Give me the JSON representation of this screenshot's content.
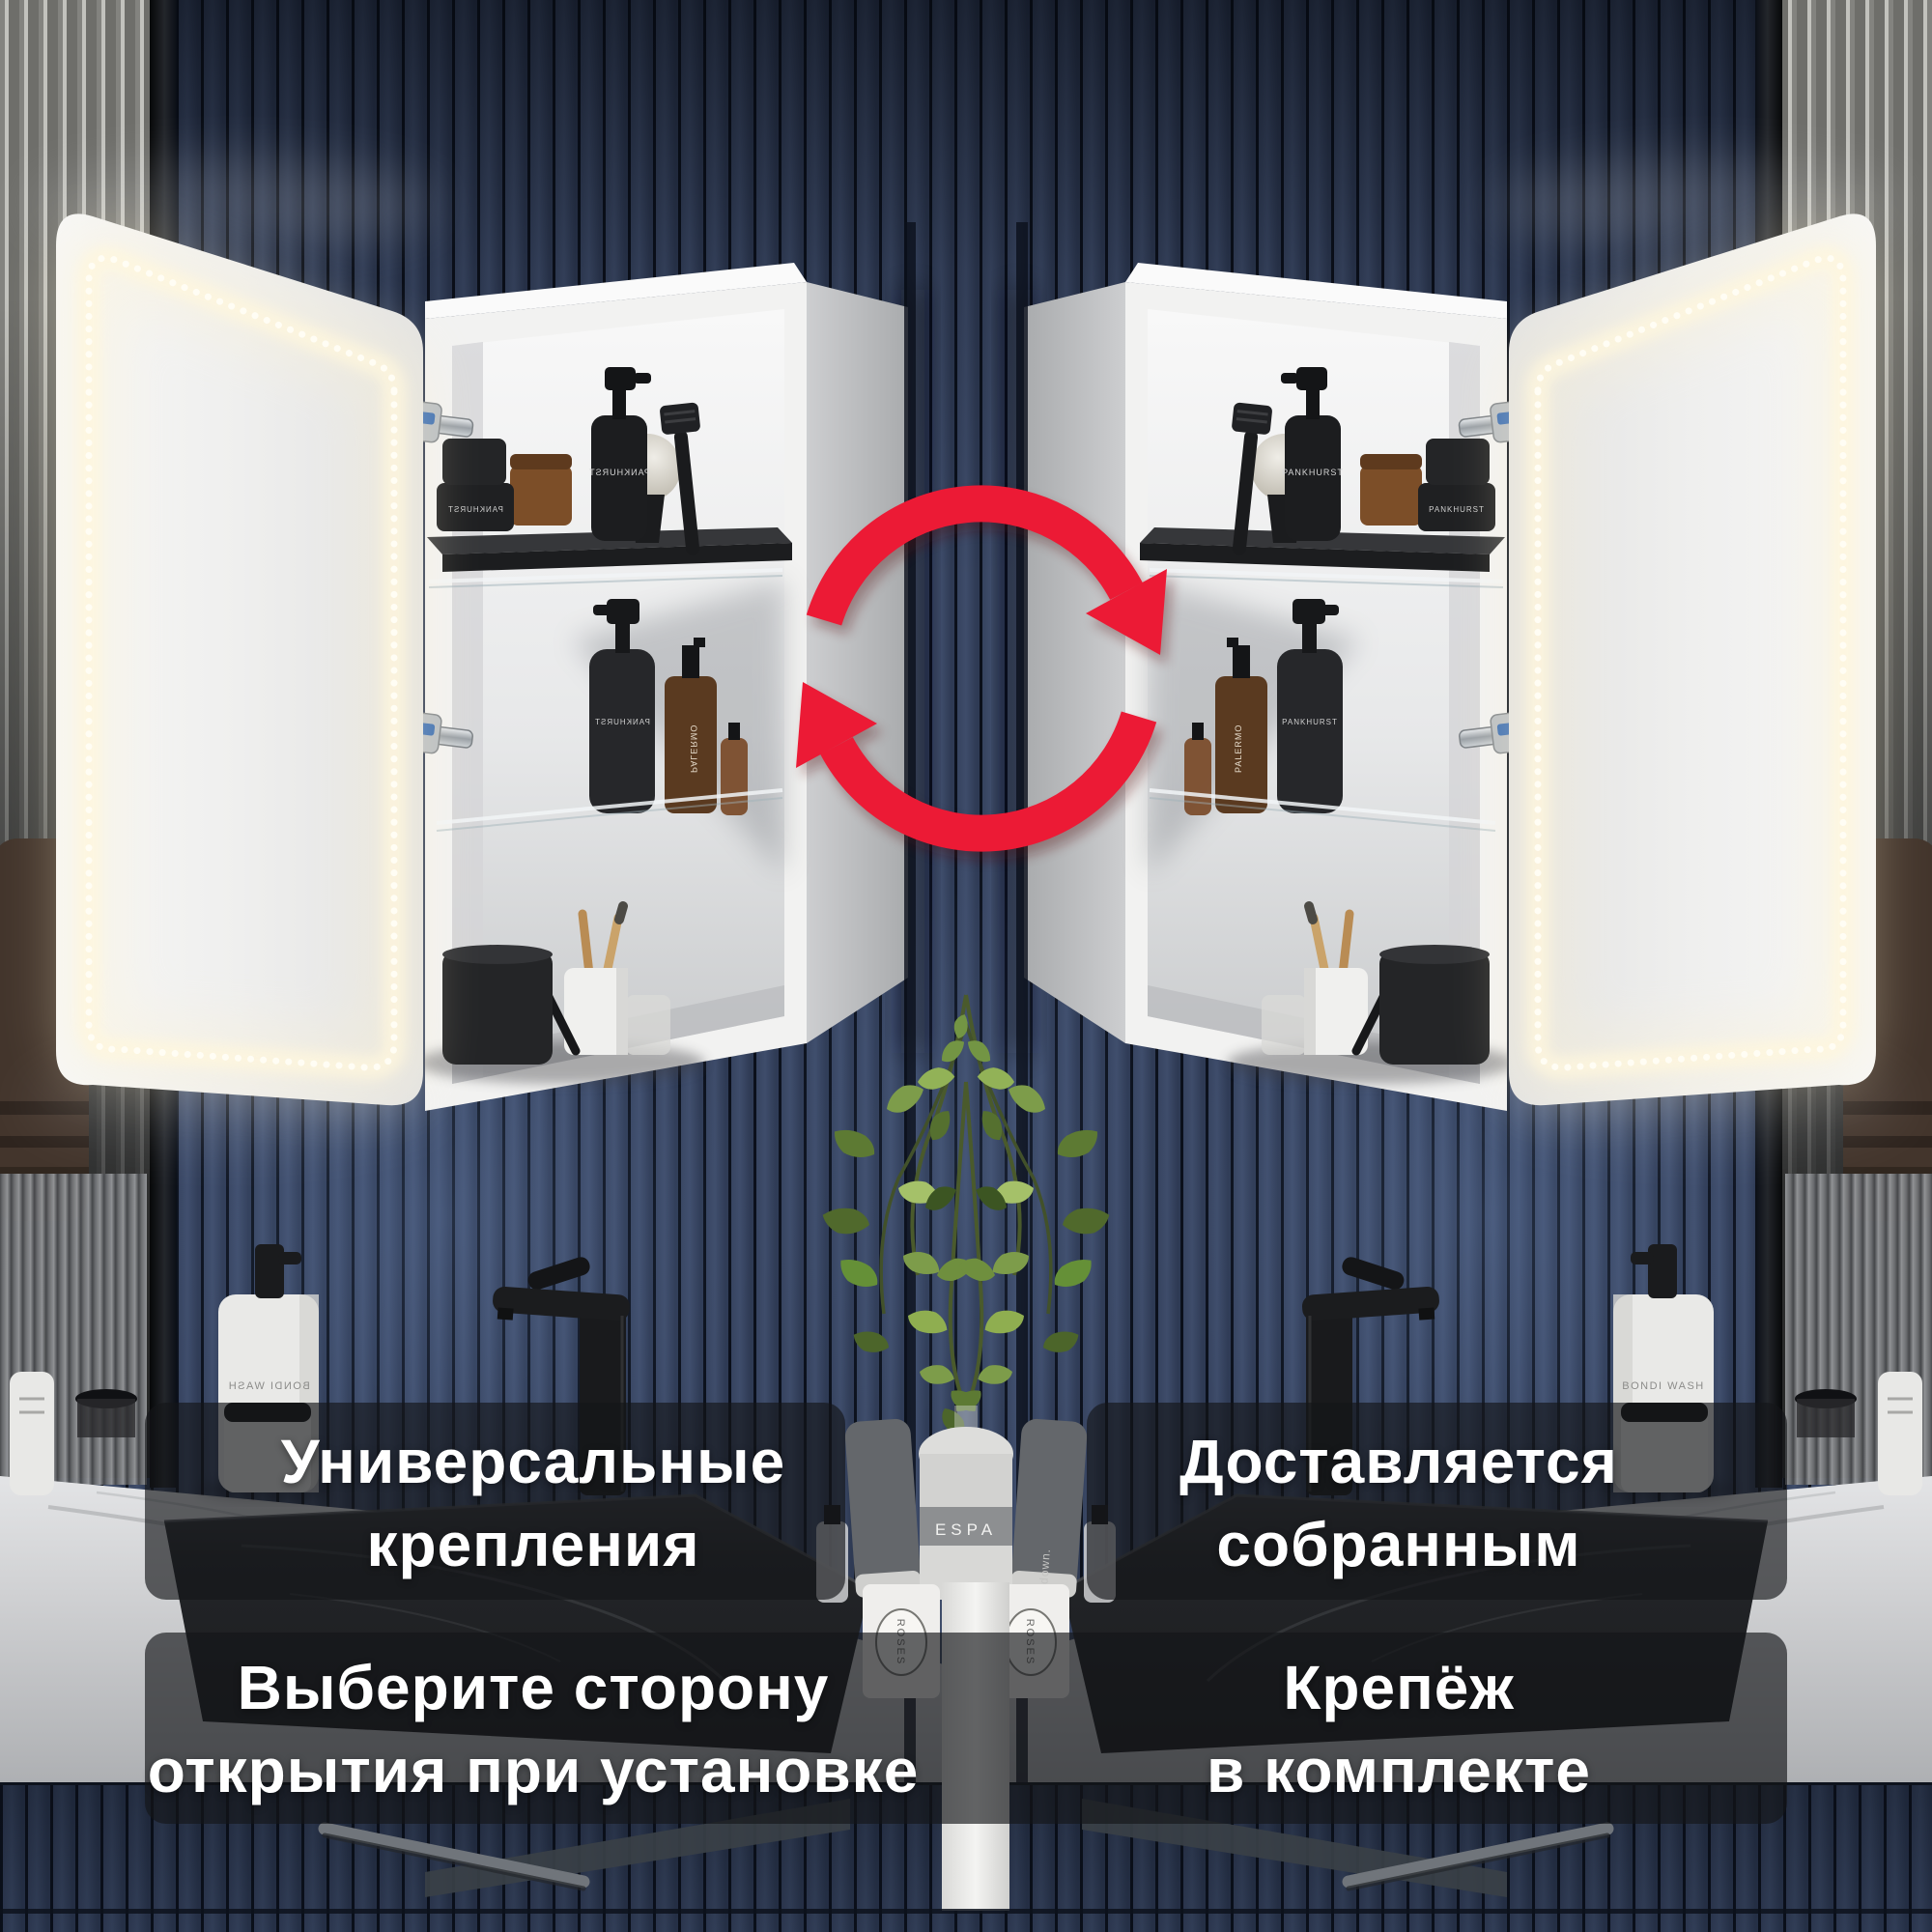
{
  "page": {
    "type": "product-infographic",
    "language": "ru",
    "size": "2000x2000"
  },
  "banners": {
    "top_left": {
      "lines": [
        "Универсальные",
        "крепления"
      ]
    },
    "top_right": {
      "lines": [
        "Доставляется",
        "собранным"
      ]
    },
    "bottom_left": {
      "lines": [
        "Выберите сторону",
        "открытия при установке"
      ]
    },
    "bottom_right": {
      "lines": [
        "Крепёж",
        "в комплекте"
      ]
    }
  },
  "icons": {
    "swap": {
      "name": "swap-rotate-arrows-icon",
      "color": "#ec1a35"
    }
  },
  "product_labels": {
    "pankhurst": "PANKHURST",
    "palermo": "PALERMO",
    "bondi": "BONDI WASH",
    "espa": "ESPA",
    "roses": "ROSES",
    "down": "down."
  },
  "colors": {
    "accent_red": "#ec1a35",
    "banner_bg": "rgba(20,21,24,0.65)",
    "banner_text": "#ffffff",
    "wall_navy": "#36435f",
    "led_warm_white": "#fff7dd",
    "cabinet_white": "#efefee",
    "plant_green": "#7d9c4a"
  }
}
